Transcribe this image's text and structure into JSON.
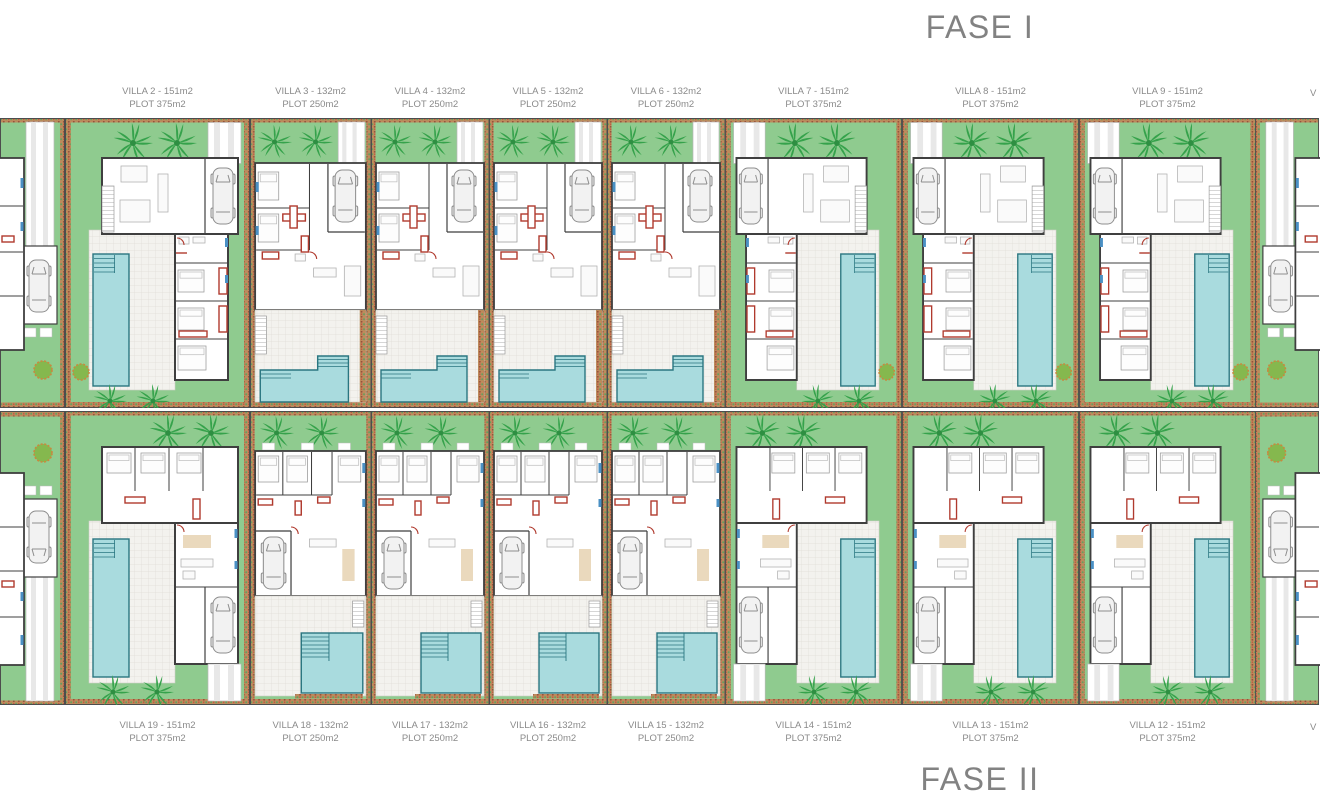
{
  "fase1": {
    "title": "FASE I",
    "edge_label": "V",
    "villas": [
      {
        "name": "VILLA 2 - 151m2",
        "plot": "PLOT 375m2",
        "type": "wide"
      },
      {
        "name": "VILLA 3 - 132m2",
        "plot": "PLOT 250m2",
        "type": "narrow"
      },
      {
        "name": "VILLA 4 - 132m2",
        "plot": "PLOT 250m2",
        "type": "narrow"
      },
      {
        "name": "VILLA 5 - 132m2",
        "plot": "PLOT 250m2",
        "type": "narrow"
      },
      {
        "name": "VILLA 6 - 132m2",
        "plot": "PLOT 250m2",
        "type": "narrow"
      },
      {
        "name": "VILLA 7 - 151m2",
        "plot": "PLOT 375m2",
        "type": "wide"
      },
      {
        "name": "VILLA 8 - 151m2",
        "plot": "PLOT 375m2",
        "type": "wide"
      },
      {
        "name": "VILLA 9 - 151m2",
        "plot": "PLOT 375m2",
        "type": "wide"
      }
    ]
  },
  "fase2": {
    "title": "FASE II",
    "edge_label": "V",
    "villas": [
      {
        "name": "VILLA 19 - 151m2",
        "plot": "PLOT 375m2",
        "type": "wide"
      },
      {
        "name": "VILLA 18 - 132m2",
        "plot": "PLOT 250m2",
        "type": "narrow"
      },
      {
        "name": "VILLA 17 - 132m2",
        "plot": "PLOT 250m2",
        "type": "narrow"
      },
      {
        "name": "VILLA 16 - 132m2",
        "plot": "PLOT 250m2",
        "type": "narrow"
      },
      {
        "name": "VILLA 15 - 132m2",
        "plot": "PLOT 250m2",
        "type": "narrow"
      },
      {
        "name": "VILLA 14 - 151m2",
        "plot": "PLOT 375m2",
        "type": "wide"
      },
      {
        "name": "VILLA 13 - 151m2",
        "plot": "PLOT 375m2",
        "type": "wide"
      },
      {
        "name": "VILLA 12 - 151m2",
        "plot": "PLOT 375m2",
        "type": "wide"
      }
    ]
  },
  "colors": {
    "lawn": "#8fcb8f",
    "palm": "#35a24b",
    "pool_fill": "#a9dbde",
    "pool_stroke": "#2a7680",
    "wall": "#3f3f3f",
    "accent_red": "#b03a2e",
    "accent_blue": "#4a90c4",
    "patio": "#f3f2ee",
    "rug_tan": "#ead9bd",
    "car_fill": "#f2f2f2",
    "car_stroke": "#8d8d8d",
    "label_text": "#8a8a8a",
    "title_text": "#828282",
    "bed_brown": "#bd8a5c",
    "bush_green": "#85b84e"
  }
}
